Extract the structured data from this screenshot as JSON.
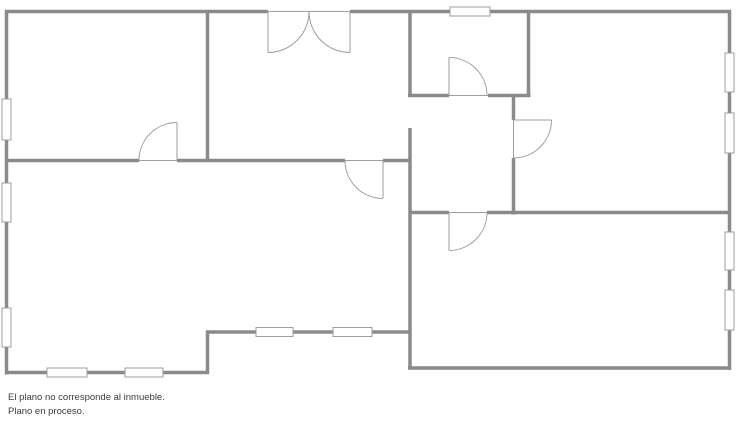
{
  "disclaimer": {
    "line1": "El plano no corresponde al inmueble.",
    "line2": "Plano en proceso."
  },
  "floorplan": {
    "canvas": {
      "width": 736,
      "height": 424
    },
    "style": {
      "background": "#ffffff",
      "wall_color": "#8a8a8a",
      "wall_width": 3.5,
      "thin_color": "#9e9e9e",
      "thin_width": 1,
      "window_fill": "#ffffff",
      "window_border": "#9e9e9e",
      "text_color": "#3b3b3b"
    },
    "walls": [
      {
        "x1": 5,
        "y1": 11.5,
        "x2": 268,
        "y2": 11.5
      },
      {
        "x1": 350,
        "y1": 11.5,
        "x2": 731,
        "y2": 11.5
      },
      {
        "x1": 6.5,
        "y1": 10,
        "x2": 6.5,
        "y2": 374.5
      },
      {
        "x1": 729.5,
        "y1": 10,
        "x2": 729.5,
        "y2": 370
      },
      {
        "x1": 5,
        "y1": 372.5,
        "x2": 209,
        "y2": 372.5
      },
      {
        "x1": 207.5,
        "y1": 330.5,
        "x2": 207.5,
        "y2": 374
      },
      {
        "x1": 206,
        "y1": 332,
        "x2": 411.5,
        "y2": 332
      },
      {
        "x1": 408,
        "y1": 368,
        "x2": 731,
        "y2": 368
      },
      {
        "x1": 207.5,
        "y1": 10,
        "x2": 207.5,
        "y2": 162
      },
      {
        "x1": 5,
        "y1": 160.5,
        "x2": 139,
        "y2": 160.5
      },
      {
        "x1": 177,
        "y1": 160.5,
        "x2": 345,
        "y2": 160.5
      },
      {
        "x1": 383,
        "y1": 160.5,
        "x2": 411.5,
        "y2": 160.5
      },
      {
        "x1": 410,
        "y1": 10,
        "x2": 410,
        "y2": 97
      },
      {
        "x1": 410,
        "y1": 128,
        "x2": 410,
        "y2": 369.5
      },
      {
        "x1": 408,
        "y1": 95.5,
        "x2": 449,
        "y2": 95.5
      },
      {
        "x1": 488,
        "y1": 95.5,
        "x2": 530.5,
        "y2": 95.5
      },
      {
        "x1": 528.5,
        "y1": 10,
        "x2": 528.5,
        "y2": 97
      },
      {
        "x1": 513.5,
        "y1": 94,
        "x2": 513.5,
        "y2": 120
      },
      {
        "x1": 513.5,
        "y1": 158,
        "x2": 513.5,
        "y2": 214.5
      },
      {
        "x1": 408.5,
        "y1": 212.5,
        "x2": 449,
        "y2": 212.5
      },
      {
        "x1": 487,
        "y1": 212.5,
        "x2": 729,
        "y2": 212.5
      }
    ],
    "thresholds": [
      {
        "x1": 139,
        "y1": 160.5,
        "x2": 177,
        "y2": 160.5
      },
      {
        "x1": 345,
        "y1": 160.5,
        "x2": 383,
        "y2": 160.5
      },
      {
        "x1": 268,
        "y1": 11.5,
        "x2": 350,
        "y2": 11.5
      },
      {
        "x1": 449,
        "y1": 95.5,
        "x2": 488,
        "y2": 95.5
      },
      {
        "x1": 513.5,
        "y1": 120,
        "x2": 513.5,
        "y2": 158
      },
      {
        "x1": 449,
        "y1": 212.5,
        "x2": 487,
        "y2": 212.5
      }
    ],
    "door_panels": [
      {
        "x1": 177,
        "y1": 122.5,
        "x2": 177,
        "y2": 160.5
      },
      {
        "x1": 383,
        "y1": 160.5,
        "x2": 383,
        "y2": 198.5
      },
      {
        "x1": 268,
        "y1": 11.5,
        "x2": 268,
        "y2": 52.5
      },
      {
        "x1": 350,
        "y1": 11.5,
        "x2": 350,
        "y2": 52.5
      },
      {
        "x1": 449,
        "y1": 57.5,
        "x2": 449,
        "y2": 95.5
      },
      {
        "x1": 513.5,
        "y1": 120,
        "x2": 551.5,
        "y2": 120
      },
      {
        "x1": 449,
        "y1": 212.5,
        "x2": 449,
        "y2": 250.5
      }
    ],
    "door_arcs": [
      {
        "x1": 139,
        "y1": 160.5,
        "r": 38,
        "sweep": 1,
        "x2": 177,
        "y2": 122.5
      },
      {
        "x1": 345,
        "y1": 160.5,
        "r": 38,
        "sweep": 0,
        "x2": 383,
        "y2": 198.5
      },
      {
        "x1": 309,
        "y1": 11.5,
        "r": 41,
        "sweep": 1,
        "x2": 268,
        "y2": 52.5
      },
      {
        "x1": 309,
        "y1": 11.5,
        "r": 41,
        "sweep": 0,
        "x2": 350,
        "y2": 52.5
      },
      {
        "x1": 449,
        "y1": 57.5,
        "r": 38,
        "sweep": 1,
        "x2": 487,
        "y2": 95.5
      },
      {
        "x1": 551.5,
        "y1": 120,
        "r": 38,
        "sweep": 1,
        "x2": 513.5,
        "y2": 158
      },
      {
        "x1": 487,
        "y1": 212.5,
        "r": 38,
        "sweep": 1,
        "x2": 449,
        "y2": 250.5
      }
    ],
    "windows": [
      {
        "x": 2,
        "y": 99,
        "w": 9,
        "h": 41
      },
      {
        "x": 2,
        "y": 183,
        "w": 9,
        "h": 39
      },
      {
        "x": 2,
        "y": 308,
        "w": 9,
        "h": 39
      },
      {
        "x": 450,
        "y": 7,
        "w": 40,
        "h": 9
      },
      {
        "x": 725,
        "y": 53,
        "w": 9,
        "h": 39
      },
      {
        "x": 725,
        "y": 113,
        "w": 9,
        "h": 40
      },
      {
        "x": 725,
        "y": 232,
        "w": 9,
        "h": 38
      },
      {
        "x": 725,
        "y": 290,
        "w": 9,
        "h": 40
      },
      {
        "x": 47,
        "y": 368,
        "w": 40,
        "h": 9
      },
      {
        "x": 125,
        "y": 368,
        "w": 38,
        "h": 9
      },
      {
        "x": 256,
        "y": 327.5,
        "w": 37,
        "h": 9
      },
      {
        "x": 333,
        "y": 327.5,
        "w": 39,
        "h": 9
      }
    ]
  }
}
